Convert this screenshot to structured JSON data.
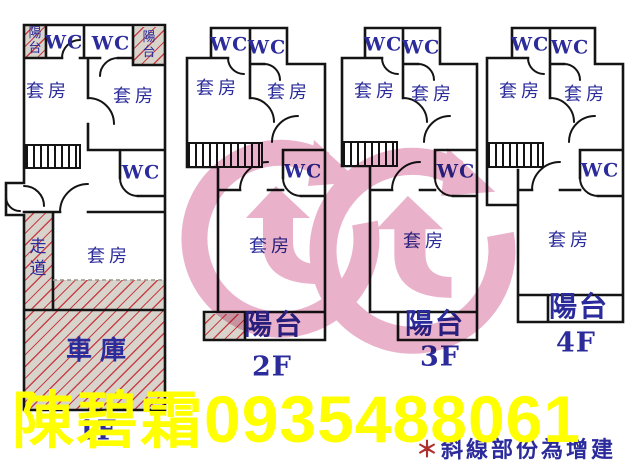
{
  "colors": {
    "wall": "#141414",
    "room_label": "#2b2b9b",
    "hatch_background": "#d8d4cc",
    "hatch_line": "#c8404a",
    "watermark_pink": "#d9739f",
    "agent_text": "#ffff00",
    "note_text": "#2b2b9b",
    "note_mark": "#b03030"
  },
  "agent": {
    "name": "陳碧霜",
    "phone": "0935488061"
  },
  "note": {
    "mark": "＊",
    "text": "斜線部份為增建"
  },
  "floors": [
    {
      "label": "1F",
      "balcony_left": "陽台",
      "wc_top_left": "WC",
      "wc_top_right": "WC",
      "balcony_right": "陽台",
      "suite_left": "套房",
      "suite_right": "套房",
      "wc_mid": "WC",
      "corridor": "走道",
      "suite_bottom": "套房",
      "garage": "車庫"
    },
    {
      "label": "2F",
      "wc_top_left": "WC",
      "wc_top_right": "WC",
      "suite_left": "套房",
      "suite_right": "套房",
      "wc_mid": "WC",
      "suite_bottom": "套房",
      "balcony": "陽台"
    },
    {
      "label": "3F",
      "wc_top_left": "WC",
      "wc_top_right": "WC",
      "suite_left": "套房",
      "suite_right": "套房",
      "wc_mid": "WC",
      "suite_bottom": "套房",
      "balcony": "陽台"
    },
    {
      "label": "4F",
      "wc_top_left": "WC",
      "wc_top_right": "WC",
      "suite_left": "套房",
      "suite_right": "套房",
      "wc_mid": "WC",
      "suite_bottom": "套房",
      "balcony": "陽台"
    }
  ]
}
